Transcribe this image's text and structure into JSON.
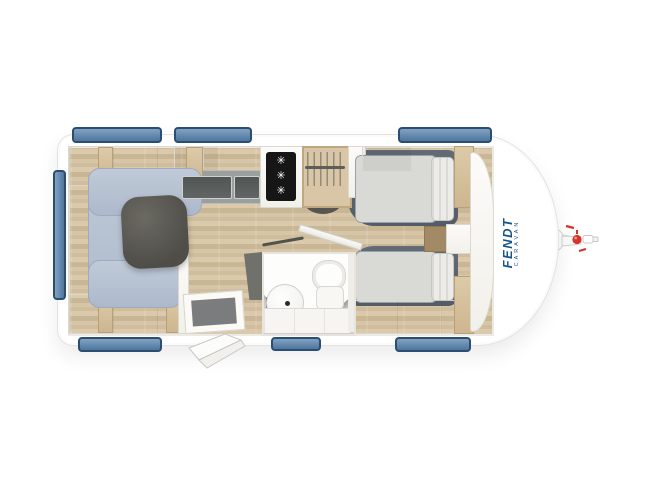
{
  "title": "caravan-floorplan-top-view",
  "brand": {
    "name": "FENDT",
    "sub": "CARAVAN"
  },
  "kitchen": {
    "burner_glyph": "✳",
    "burners": 3
  },
  "windows": {
    "top": 3,
    "bottom": 3,
    "left": 1
  },
  "colors": {
    "window_blue": "#5d84ab",
    "window_border": "#2b4d72",
    "logo_blue": "#16558c",
    "hitch_red": "#d8342a",
    "sofa_blue_gray": "#b6c1d1",
    "bed_frame_gray": "#5b626e",
    "floor_wood": "#d6c4a5",
    "furniture_white": "#fbfaf8",
    "trim_wood": "#d5c3a1",
    "table_dark": "#4e4d48"
  }
}
